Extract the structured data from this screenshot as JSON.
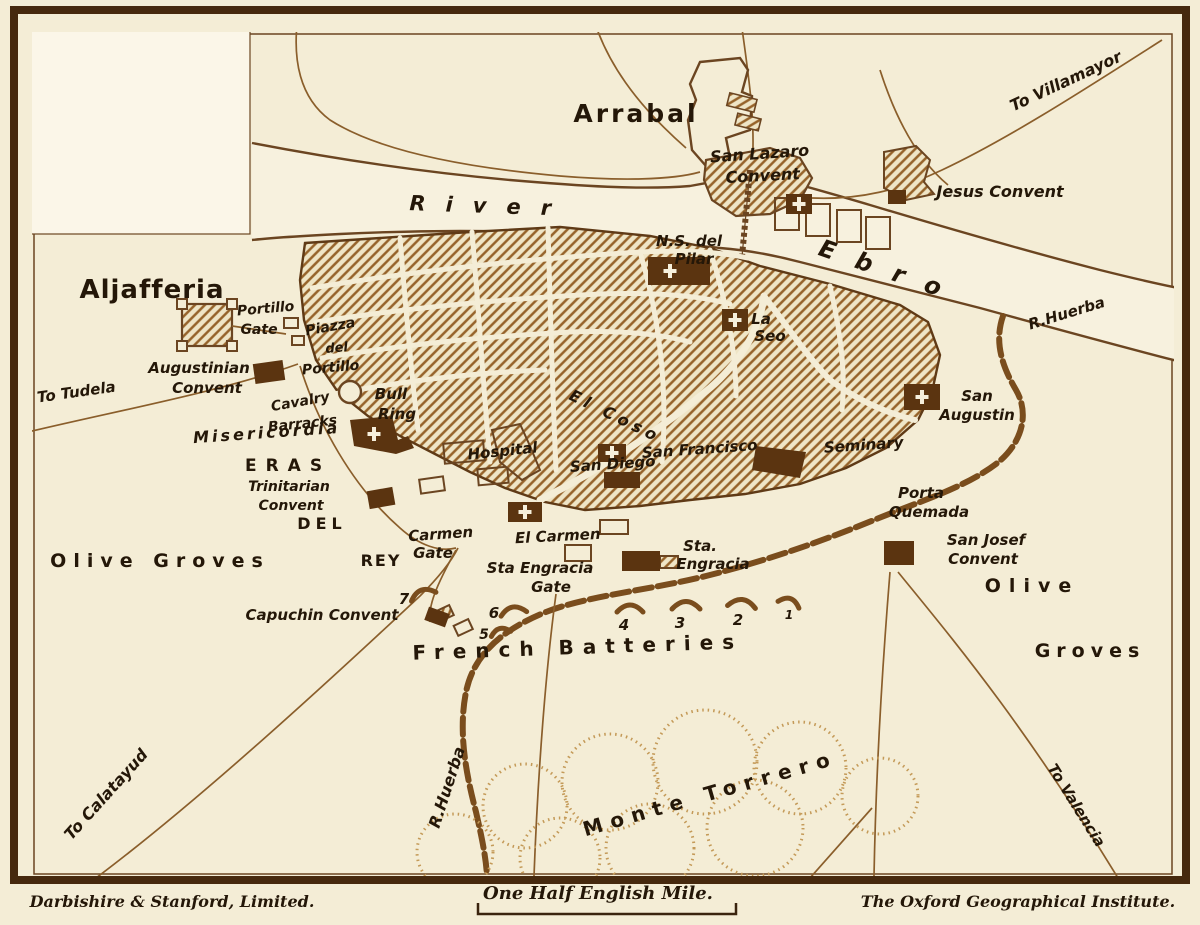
{
  "imprint": {
    "left": "Darbishire & Stanford, Limited.",
    "right": "The Oxford Geographical Institute."
  },
  "scale": {
    "label": "One Half English Mile."
  },
  "colors": {
    "paper": "#f4edd6",
    "paper_light": "#fbf6e8",
    "ink": "#6b4521",
    "dark_building": "#5b3410",
    "hatch": "#96632a",
    "text": "#241708",
    "frame": "#46290e",
    "stipple": "#c49a58"
  },
  "map": {
    "labels": [
      {
        "n": "label-arrabal",
        "t": "Arrabal",
        "x": 636,
        "y": 122,
        "s": 25,
        "ls": 3,
        "c": "d"
      },
      {
        "n": "label-aljafferia",
        "t": "Aljafferia",
        "x": 152,
        "y": 298,
        "s": 26,
        "ls": 1,
        "c": "d"
      },
      {
        "n": "label-eras",
        "t": "ERAS",
        "x": 288,
        "y": 471,
        "s": 17,
        "ls": 9,
        "c": "d"
      },
      {
        "n": "label-del",
        "t": "DEL",
        "x": 322,
        "y": 529,
        "s": 16,
        "ls": 5,
        "c": "d"
      },
      {
        "n": "label-rey",
        "t": "REY",
        "x": 381,
        "y": 566,
        "s": 16,
        "ls": 2,
        "c": "d"
      },
      {
        "n": "label-olive-groves-west",
        "t": "Olive Groves",
        "x": 160,
        "y": 567,
        "s": 19,
        "ls": 7,
        "c": "d"
      },
      {
        "n": "label-olive-east",
        "t": "Olive",
        "x": 1032,
        "y": 592,
        "s": 19,
        "ls": 8,
        "c": "d"
      },
      {
        "n": "label-groves-east",
        "t": "Groves",
        "x": 1090,
        "y": 657,
        "s": 19,
        "ls": 6,
        "c": "d"
      },
      {
        "n": "label-french-batteries",
        "t": "French Batteries",
        "x": 578,
        "y": 654,
        "s": 20,
        "ls": 9,
        "r": -2,
        "c": "d"
      },
      {
        "n": "label-monte-torrero",
        "t": "Monte Torrero",
        "x": 712,
        "y": 800,
        "s": 20,
        "ls": 8,
        "r": -16,
        "c": "d"
      },
      {
        "n": "label-river",
        "t": "River",
        "x": 490,
        "y": 213,
        "s": 21,
        "ls": 20,
        "r": 2,
        "c": "p"
      },
      {
        "n": "label-ebro",
        "t": "Ebro",
        "x": 888,
        "y": 279,
        "s": 24,
        "ls": 22,
        "r": 19,
        "c": "p"
      },
      {
        "n": "label-to-villamayor",
        "t": "To Villamayor",
        "x": 1068,
        "y": 86,
        "s": 16,
        "r": -25,
        "c": "p"
      },
      {
        "n": "label-jesus-convent",
        "t": "Jesus Convent",
        "x": 1000,
        "y": 197,
        "s": 16,
        "c": "p"
      },
      {
        "n": "label-san-lazaro-line1",
        "t": "San Lazaro",
        "x": 760,
        "y": 159,
        "s": 16,
        "r": -4,
        "c": "p"
      },
      {
        "n": "label-san-lazaro-line2",
        "t": "Convent",
        "x": 763,
        "y": 181,
        "s": 16,
        "r": -3,
        "c": "p"
      },
      {
        "n": "label-ns-del",
        "t": "N.S. del",
        "x": 689,
        "y": 246,
        "s": 15,
        "c": "p"
      },
      {
        "n": "label-pilar",
        "t": "Pilar",
        "x": 694,
        "y": 264,
        "s": 15,
        "c": "p"
      },
      {
        "n": "label-la",
        "t": "La",
        "x": 761,
        "y": 324,
        "s": 15,
        "c": "p"
      },
      {
        "n": "label-seo",
        "t": "Seo",
        "x": 770,
        "y": 341,
        "s": 15,
        "c": "p"
      },
      {
        "n": "label-r-huerba-ne",
        "t": "R.Huerba",
        "x": 1068,
        "y": 318,
        "s": 15,
        "r": -17,
        "c": "p"
      },
      {
        "n": "label-portillo-gate1",
        "t": "Portillo",
        "x": 266,
        "y": 313,
        "s": 14,
        "r": -5,
        "c": "p"
      },
      {
        "n": "label-portillo-gate2",
        "t": "Gate",
        "x": 259,
        "y": 334,
        "s": 14,
        "c": "p"
      },
      {
        "n": "label-piazza1",
        "t": "Piazza",
        "x": 331,
        "y": 331,
        "s": 14,
        "r": -10,
        "c": "p"
      },
      {
        "n": "label-piazza2",
        "t": "del",
        "x": 337,
        "y": 352,
        "s": 13,
        "r": -5,
        "c": "p"
      },
      {
        "n": "label-piazza3",
        "t": "Portillo",
        "x": 331,
        "y": 372,
        "s": 14,
        "r": -5,
        "c": "p"
      },
      {
        "n": "label-augustinian1",
        "t": "Augustinian",
        "x": 199,
        "y": 373,
        "s": 15,
        "c": "p"
      },
      {
        "n": "label-augustinian2",
        "t": "Convent",
        "x": 207,
        "y": 393,
        "s": 15,
        "c": "p"
      },
      {
        "n": "label-to-tudela",
        "t": "To Tudela",
        "x": 77,
        "y": 397,
        "s": 15,
        "r": -8,
        "c": "p"
      },
      {
        "n": "label-cavalry1",
        "t": "Cavalry",
        "x": 301,
        "y": 406,
        "s": 14,
        "r": -10,
        "c": "p"
      },
      {
        "n": "label-cavalry2",
        "t": "Barracks",
        "x": 303,
        "y": 428,
        "s": 14,
        "r": -6,
        "c": "p"
      },
      {
        "n": "label-bull",
        "t": "Bull",
        "x": 391,
        "y": 399,
        "s": 15,
        "c": "p"
      },
      {
        "n": "label-ring",
        "t": "Ring",
        "x": 397,
        "y": 419,
        "s": 15,
        "c": "p"
      },
      {
        "n": "label-misericordia",
        "t": "Misericordia",
        "x": 267,
        "y": 438,
        "s": 16,
        "ls": 3,
        "r": -4,
        "c": "p"
      },
      {
        "n": "label-trinitarian1",
        "t": "Trinitarian",
        "x": 289,
        "y": 491,
        "s": 14,
        "c": "p"
      },
      {
        "n": "label-trinitarian2",
        "t": "Convent",
        "x": 291,
        "y": 510,
        "s": 14,
        "c": "p"
      },
      {
        "n": "label-hospital",
        "t": "Hospital",
        "x": 503,
        "y": 456,
        "s": 15,
        "r": -6,
        "c": "p"
      },
      {
        "n": "label-san-diego",
        "t": "San Diego",
        "x": 613,
        "y": 469,
        "s": 15,
        "r": -4,
        "c": "p"
      },
      {
        "n": "label-san-francisco",
        "t": "San Francisco",
        "x": 700,
        "y": 454,
        "s": 15,
        "r": -4,
        "c": "p"
      },
      {
        "n": "label-el-coso",
        "t": "El Coso",
        "x": 613,
        "y": 421,
        "s": 16,
        "ls": 5,
        "r": 26,
        "c": "p"
      },
      {
        "n": "label-seminary",
        "t": "Seminary",
        "x": 864,
        "y": 450,
        "s": 15,
        "r": -4,
        "c": "p"
      },
      {
        "n": "label-san-augustin1",
        "t": "San",
        "x": 977,
        "y": 401,
        "s": 15,
        "c": "p"
      },
      {
        "n": "label-san-augustin2",
        "t": "Augustin",
        "x": 977,
        "y": 420,
        "s": 15,
        "c": "p"
      },
      {
        "n": "label-porta1",
        "t": "Porta",
        "x": 921,
        "y": 498,
        "s": 15,
        "c": "p"
      },
      {
        "n": "label-porta2",
        "t": "Quemada",
        "x": 929,
        "y": 517,
        "s": 15,
        "c": "p"
      },
      {
        "n": "label-san-josef1",
        "t": "San Josef",
        "x": 986,
        "y": 545,
        "s": 15,
        "c": "p"
      },
      {
        "n": "label-san-josef2",
        "t": "Convent",
        "x": 983,
        "y": 564,
        "s": 15,
        "c": "p"
      },
      {
        "n": "label-carmen-gate1",
        "t": "Carmen",
        "x": 441,
        "y": 539,
        "s": 15,
        "r": -4,
        "c": "p"
      },
      {
        "n": "label-carmen-gate2",
        "t": "Gate",
        "x": 433,
        "y": 558,
        "s": 15,
        "c": "p"
      },
      {
        "n": "label-el-carmen",
        "t": "El Carmen",
        "x": 558,
        "y": 541,
        "s": 15,
        "r": -3,
        "c": "p"
      },
      {
        "n": "label-sta-engracia-gate1",
        "t": "Sta Engracia",
        "x": 540,
        "y": 573,
        "s": 15,
        "c": "p"
      },
      {
        "n": "label-sta-engracia-gate2",
        "t": "Gate",
        "x": 551,
        "y": 592,
        "s": 15,
        "c": "p"
      },
      {
        "n": "label-sta1",
        "t": "Sta.",
        "x": 700,
        "y": 551,
        "s": 15,
        "c": "p"
      },
      {
        "n": "label-sta2",
        "t": "Engracia",
        "x": 713,
        "y": 569,
        "s": 15,
        "c": "p"
      },
      {
        "n": "label-capuchin",
        "t": "Capuchin Convent",
        "x": 322,
        "y": 620,
        "s": 15,
        "c": "p"
      },
      {
        "n": "label-to-calatayud",
        "t": "To Calatayud",
        "x": 110,
        "y": 798,
        "s": 16,
        "r": -48,
        "c": "p"
      },
      {
        "n": "label-r-huerba-sw",
        "t": "R.Huerba",
        "x": 452,
        "y": 789,
        "s": 16,
        "r": -72,
        "c": "p"
      },
      {
        "n": "label-to-valencia",
        "t": "To Valencia",
        "x": 1072,
        "y": 808,
        "s": 15,
        "r": 58,
        "c": "p"
      },
      {
        "n": "label-battery-7",
        "t": "7",
        "x": 404,
        "y": 604,
        "s": 15,
        "c": "n"
      },
      {
        "n": "label-battery-6",
        "t": "6",
        "x": 494,
        "y": 618,
        "s": 15,
        "c": "n"
      },
      {
        "n": "label-battery-5",
        "t": "5",
        "x": 484,
        "y": 639,
        "s": 14,
        "c": "n"
      },
      {
        "n": "label-battery-4",
        "t": "4",
        "x": 624,
        "y": 630,
        "s": 15,
        "c": "n"
      },
      {
        "n": "label-battery-3",
        "t": "3",
        "x": 680,
        "y": 628,
        "s": 15,
        "c": "n"
      },
      {
        "n": "label-battery-2",
        "t": "2",
        "x": 738,
        "y": 625,
        "s": 15,
        "c": "n"
      },
      {
        "n": "label-battery-1",
        "t": "1",
        "x": 789,
        "y": 619,
        "s": 12,
        "c": "n"
      }
    ]
  }
}
